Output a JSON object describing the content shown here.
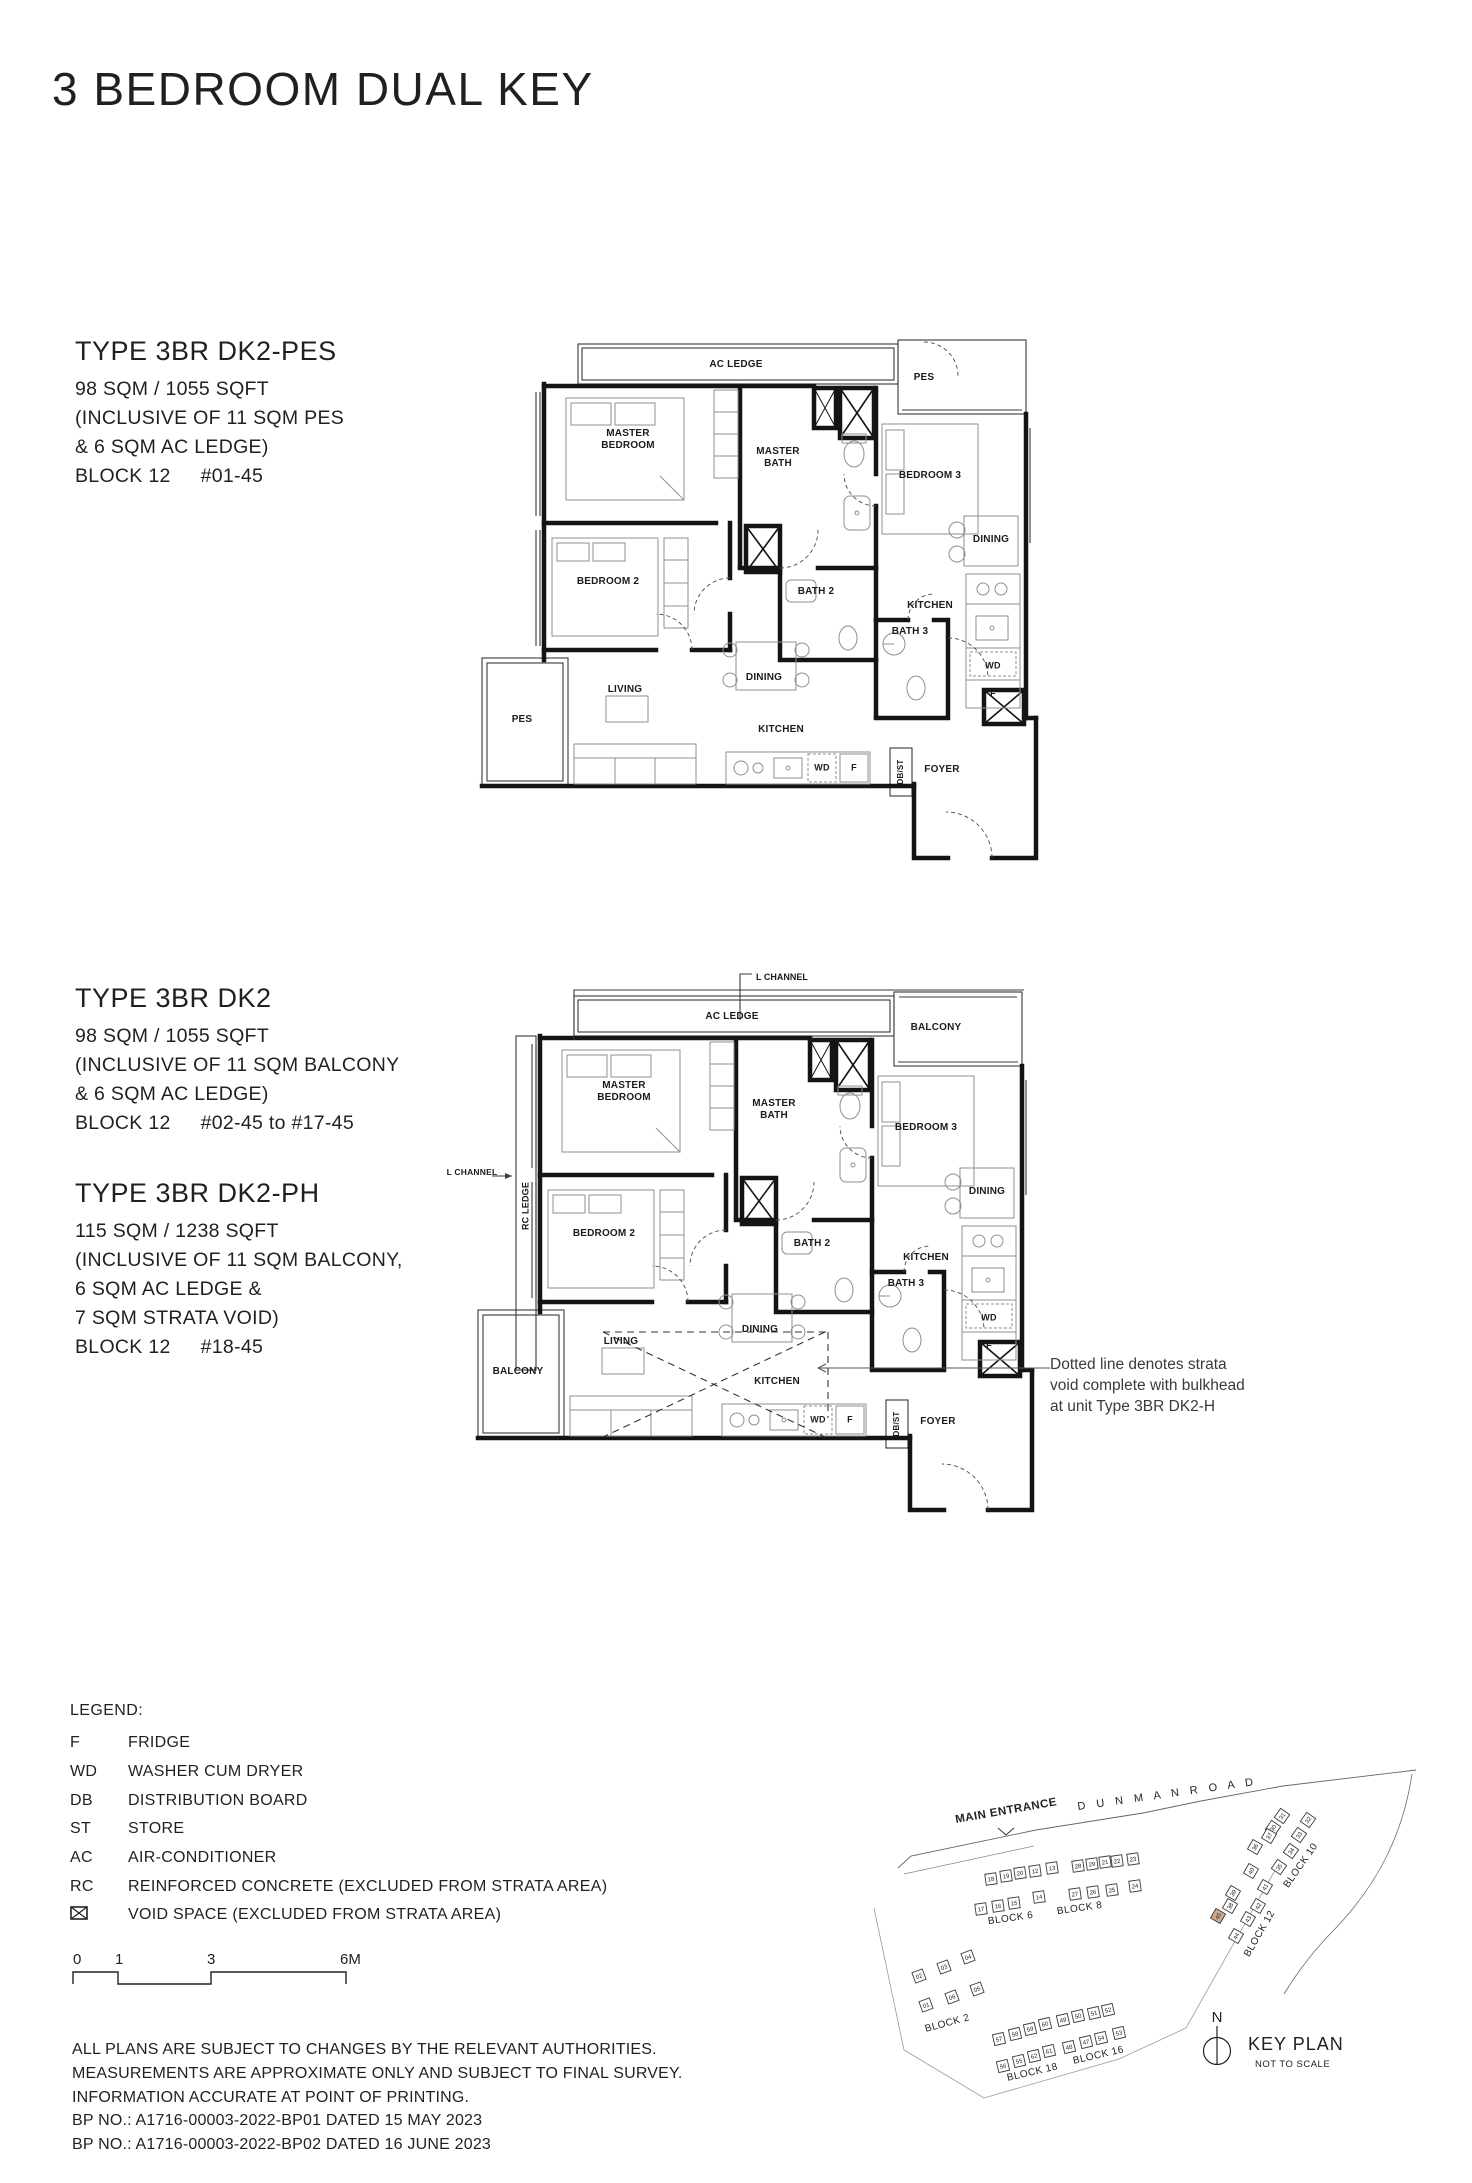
{
  "page": {
    "title": "3 BEDROOM DUAL KEY"
  },
  "specs": [
    {
      "type": "TYPE 3BR DK2-PES",
      "lines": [
        "98 SQM / 1055 SQFT",
        "(INCLUSIVE OF 11 SQM PES",
        "& 6 SQM AC LEDGE)"
      ],
      "block": "BLOCK 12",
      "levels": "#01-45"
    },
    {
      "type": "TYPE 3BR DK2",
      "lines": [
        "98 SQM / 1055 SQFT",
        "(INCLUSIVE OF 11 SQM BALCONY",
        "& 6 SQM AC LEDGE)"
      ],
      "block": "BLOCK 12",
      "levels": "#02-45 to #17-45"
    },
    {
      "type": "TYPE 3BR DK2-PH",
      "lines": [
        "115 SQM / 1238 SQFT",
        "(INCLUSIVE OF 11 SQM BALCONY,",
        "6 SQM AC LEDGE &",
        "7 SQM STRATA VOID)"
      ],
      "block": "BLOCK 12",
      "levels": "#18-45"
    }
  ],
  "plan1": {
    "labels": {
      "ac_ledge": "AC LEDGE",
      "pes_top": "PES",
      "master_bedroom": "MASTER BEDROOM",
      "master_bath": "MASTER BATH",
      "bedroom3": "BEDROOM 3",
      "dining_suite": "DINING",
      "kitchen_suite": "KITCHEN",
      "wd_suite": "WD",
      "f_suite": "F",
      "bath3": "BATH 3",
      "bedroom2": "BEDROOM 2",
      "bath2": "BATH 2",
      "dining": "DINING",
      "kitchen": "KITCHEN",
      "living": "LIVING",
      "pes_bottom": "PES",
      "wd": "WD",
      "f": "F",
      "dbst": "DB/ST",
      "foyer": "FOYER"
    }
  },
  "plan2": {
    "labels": {
      "l_channel_top": "L CHANNEL",
      "l_channel_left": "L CHANNEL",
      "rc_ledge": "RC LEDGE",
      "ac_ledge": "AC LEDGE",
      "balcony_top": "BALCONY",
      "master_bedroom": "MASTER BEDROOM",
      "master_bath": "MASTER BATH",
      "bedroom3": "BEDROOM 3",
      "dining_suite": "DINING",
      "kitchen_suite": "KITCHEN",
      "wd_suite": "WD",
      "f_suite": "F",
      "bath3": "BATH 3",
      "bedroom2": "BEDROOM 2",
      "bath2": "BATH 2",
      "dining": "DINING",
      "kitchen": "KITCHEN",
      "living": "LIVING",
      "balcony_bottom": "BALCONY",
      "wd": "WD",
      "f": "F",
      "dbst": "DB/ST",
      "foyer": "FOYER"
    },
    "annotation": [
      "Dotted line denotes strata",
      "void complete with bulkhead",
      "at unit Type 3BR DK2-H"
    ]
  },
  "legend": {
    "title": "LEGEND:",
    "items": [
      {
        "abbr": "F",
        "desc": "FRIDGE"
      },
      {
        "abbr": "WD",
        "desc": "WASHER CUM DRYER"
      },
      {
        "abbr": "DB",
        "desc": "DISTRIBUTION BOARD"
      },
      {
        "abbr": "ST",
        "desc": "STORE"
      },
      {
        "abbr": "AC",
        "desc": "AIR-CONDITIONER"
      },
      {
        "abbr": "RC",
        "desc": "REINFORCED CONCRETE (EXCLUDED FROM STRATA AREA)"
      },
      {
        "abbr": "",
        "desc": "VOID SPACE (EXCLUDED FROM STRATA AREA)",
        "icon": "void-space-icon"
      }
    ]
  },
  "scalebar": {
    "labels": [
      "0",
      "1",
      "3",
      "6M"
    ]
  },
  "disclaimer": [
    "ALL PLANS ARE SUBJECT TO CHANGES BY THE RELEVANT AUTHORITIES.",
    "MEASUREMENTS ARE APPROXIMATE ONLY AND SUBJECT TO FINAL SURVEY.",
    "INFORMATION ACCURATE AT POINT OF PRINTING.",
    "BP NO.: A1716-00003-2022-BP01 DATED 15 MAY 2023",
    "BP NO.: A1716-00003-2022-BP02 DATED 16 JUNE 2023"
  ],
  "keyplan": {
    "main_entrance": "MAIN ENTRANCE",
    "road": "D U N M A N   R O A D",
    "north": "N",
    "title": "KEY PLAN",
    "subtitle": "NOT TO SCALE",
    "highlight_color": "#d2a98b",
    "blocks": [
      {
        "label": "BLOCK 2",
        "units": [
          "02",
          "03",
          "04",
          "01",
          "06",
          "05"
        ]
      },
      {
        "label": "BLOCK 6",
        "units": [
          "18",
          "19",
          "20",
          "12",
          "13",
          "17",
          "16",
          "15",
          "14"
        ]
      },
      {
        "label": "BLOCK 8",
        "units": [
          "28",
          "29",
          "21",
          "22",
          "23",
          "27",
          "26",
          "25",
          "24"
        ]
      },
      {
        "label": "BLOCK 10",
        "units": [
          "31",
          "32",
          "30",
          "33",
          "34",
          "35"
        ]
      },
      {
        "label": "BLOCK 12",
        "units": [
          "37",
          "36",
          "40",
          "39",
          "38",
          "41",
          "42",
          "43",
          "45",
          "44"
        ],
        "highlight": "45"
      },
      {
        "label": "BLOCK 16",
        "units": [
          "49",
          "50",
          "51",
          "52",
          "48",
          "47",
          "54",
          "53"
        ]
      },
      {
        "label": "BLOCK 18",
        "units": [
          "57",
          "58",
          "59",
          "60",
          "56",
          "55",
          "62",
          "61"
        ]
      }
    ]
  }
}
